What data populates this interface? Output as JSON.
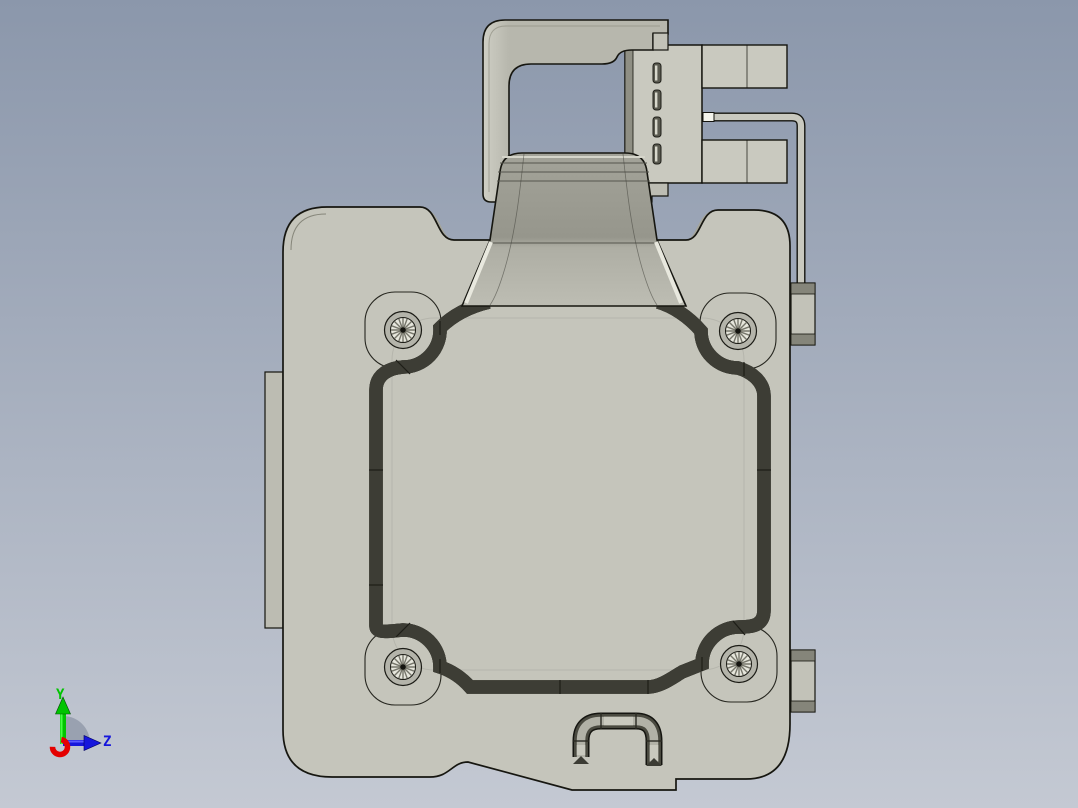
{
  "viewport": {
    "type": "cad-3d-viewport",
    "background_top": "#8b97ab",
    "background_bottom": "#c4c9d3"
  },
  "model": {
    "face_color": "#c5c5bb",
    "edge_band_color": "#75756a",
    "chamfer_color": "#a5a59a",
    "outline_color": "#161610",
    "groove_light": "#b9b9ae",
    "groove_bright": "#e6e6dc",
    "screw_count": "4"
  },
  "axis_triad": {
    "y_axis": {
      "label": "Y",
      "color": "#00c400",
      "bright": "#46ff46"
    },
    "z_axis": {
      "label": "Z",
      "color": "#1616dc",
      "bright": "#5a5aff"
    },
    "x_axis": {
      "color": "#e40000"
    },
    "arc_color": "#99a1b0"
  }
}
